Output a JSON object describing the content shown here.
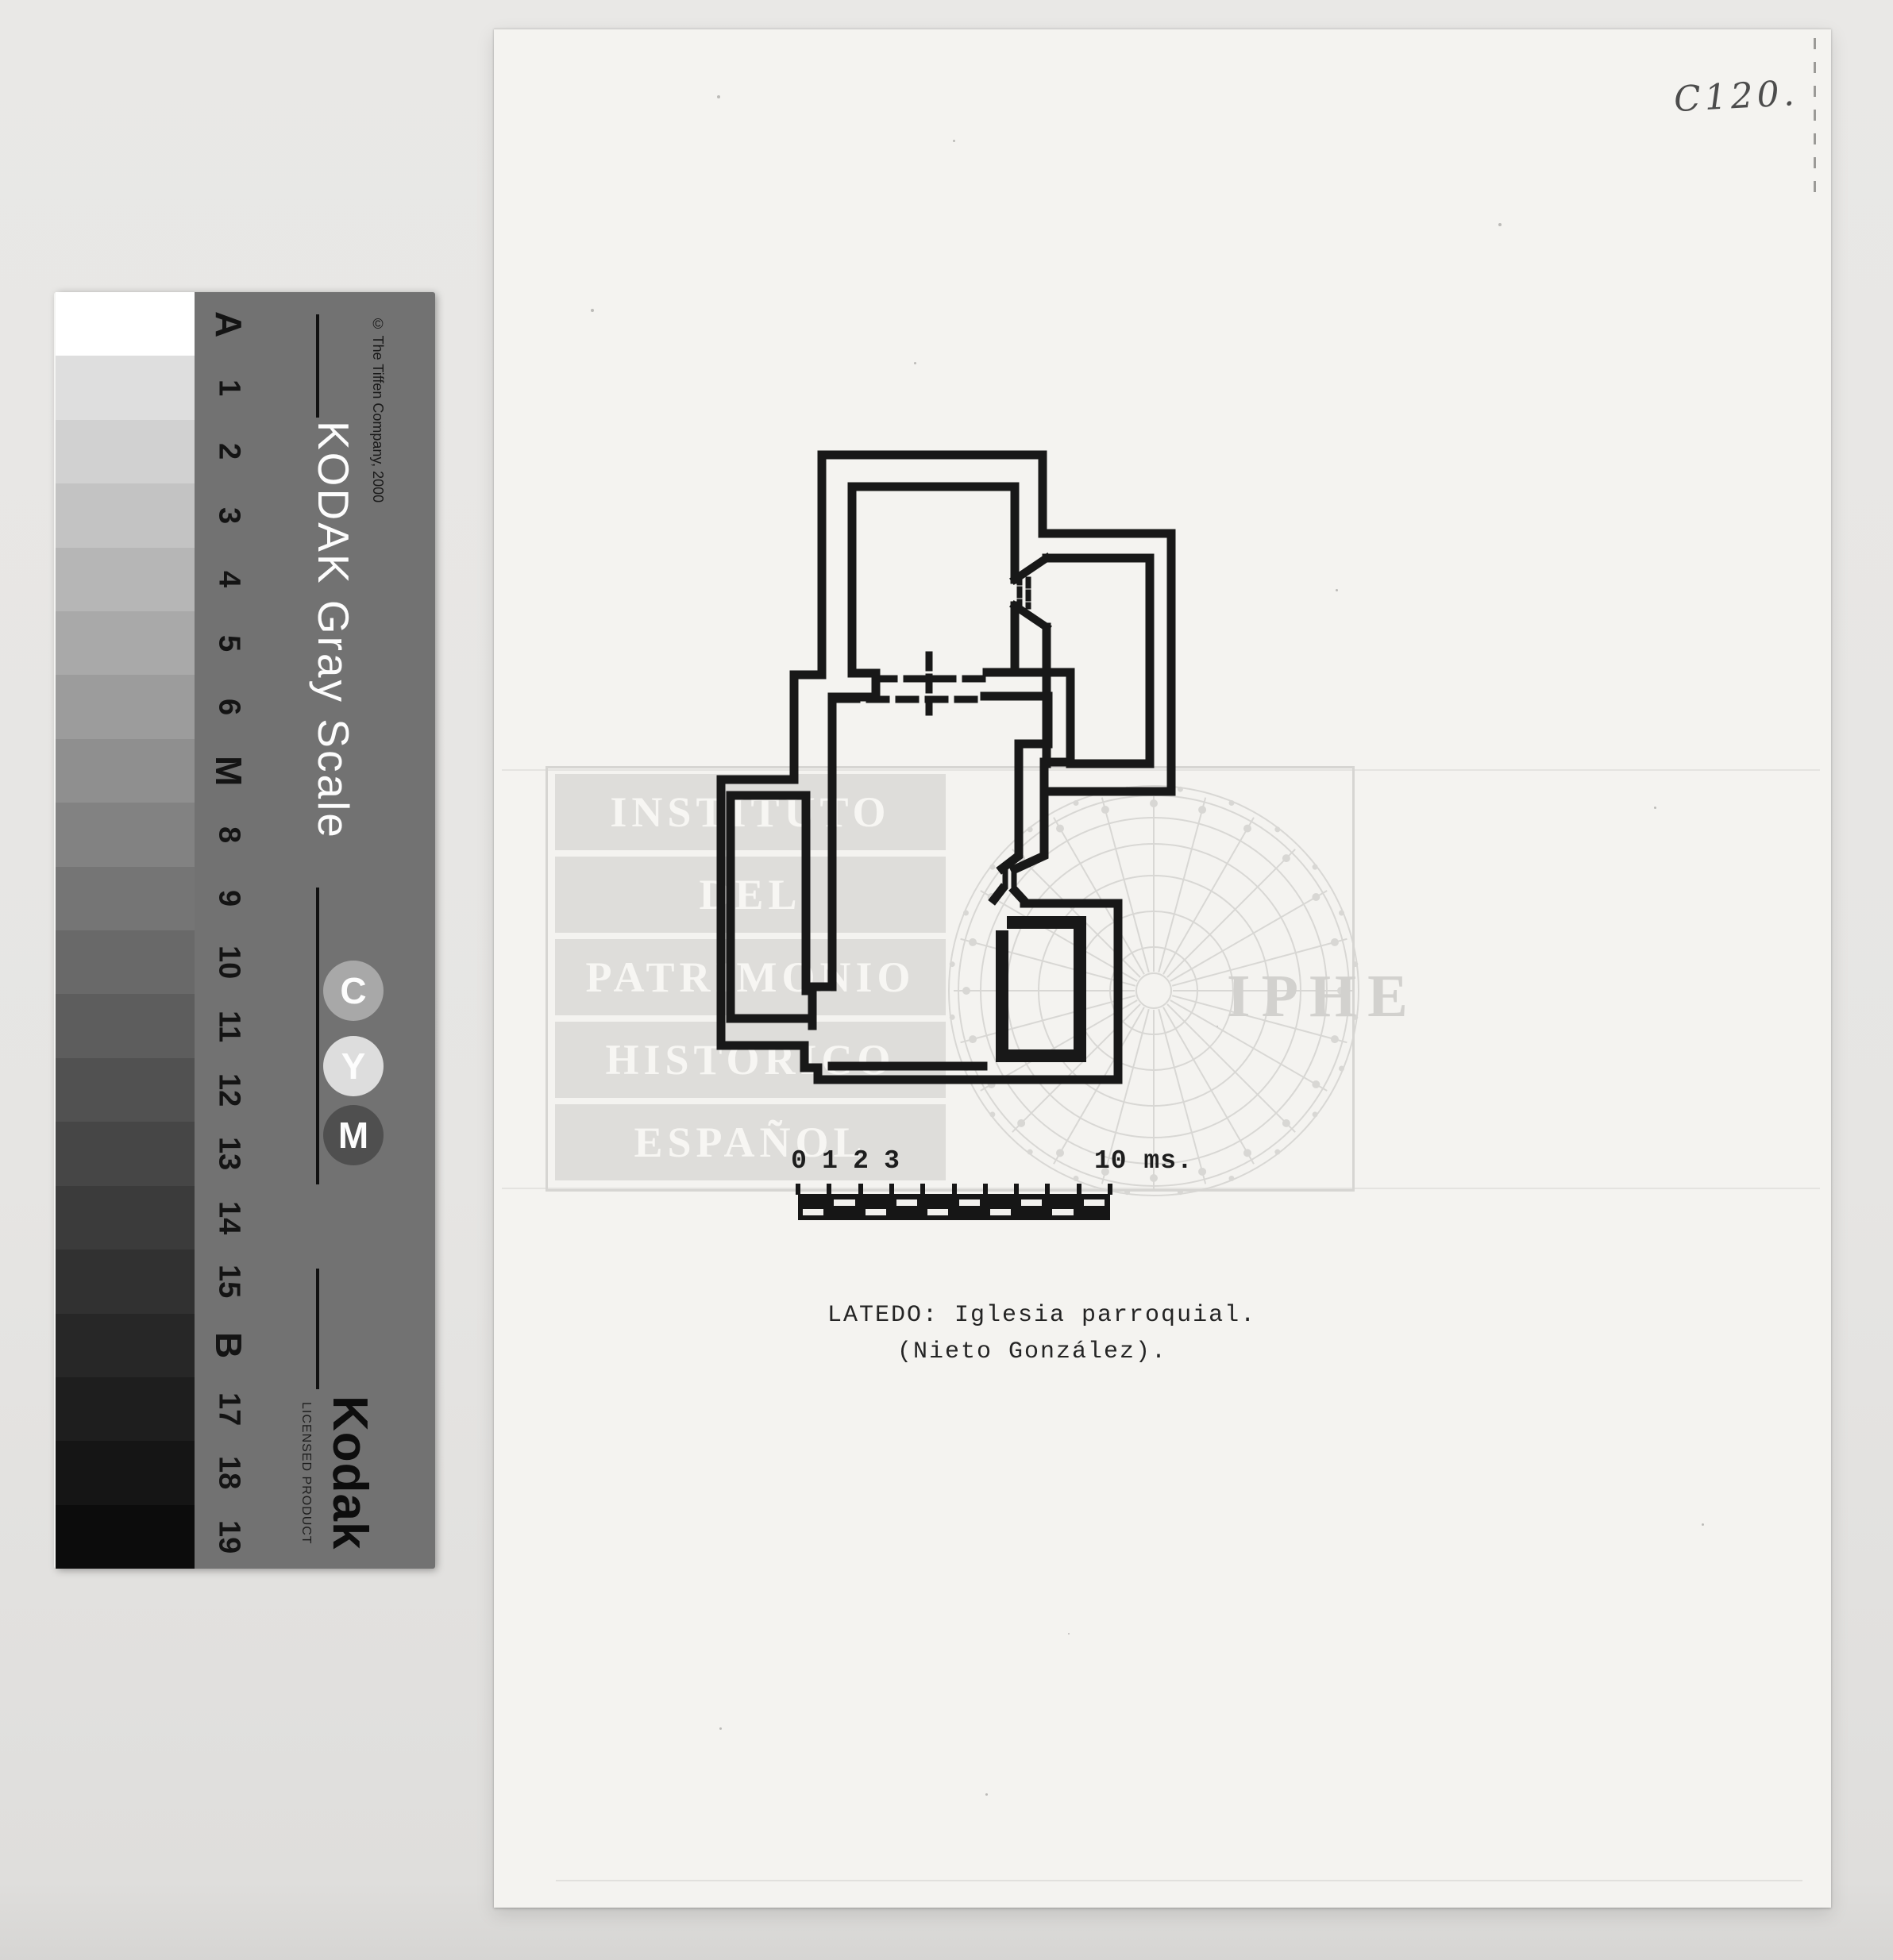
{
  "page": {
    "code": "C120."
  },
  "caption": {
    "line1": "LATEDO: Iglesia parroquial.",
    "line2": "(Nieto González)."
  },
  "scale_bar": {
    "tick_labels": [
      "0",
      "1",
      "2",
      "3"
    ],
    "end_label": "10 ms.",
    "divisions": 10
  },
  "watermark": {
    "lines": [
      "INSTITUTO",
      "DEL",
      "PATRIMONIO",
      "HISTORICO",
      "ESPAÑOL"
    ],
    "acronym": "IPHE"
  },
  "gray_scale": {
    "title": "KODAK Gray Scale",
    "copyright": "© The Tiffen Company, 2000",
    "brand": "Kodak",
    "brand_subtitle": "LICENSED PRODUCT",
    "step_labels": [
      "A",
      "1",
      "2",
      "3",
      "4",
      "5",
      "6",
      "M",
      "8",
      "9",
      "10",
      "11",
      "12",
      "13",
      "14",
      "15",
      "B",
      "17",
      "18",
      "19"
    ],
    "patch_shades": [
      "#ffffff",
      "#dedede",
      "#d1d1d1",
      "#c3c3c3",
      "#b6b6b6",
      "#a9a9a9",
      "#9c9c9c",
      "#8f8f8f",
      "#828282",
      "#757575",
      "#696969",
      "#5d5d5d",
      "#515151",
      "#464646",
      "#3b3b3b",
      "#313131",
      "#272727",
      "#1e1e1e",
      "#151515",
      "#0c0c0c"
    ],
    "cym_badges": [
      {
        "letter": "C",
        "color": "#a8a8a8"
      },
      {
        "letter": "Y",
        "color": "#dddddd"
      },
      {
        "letter": "M",
        "color": "#4f4f4f"
      }
    ],
    "panel_color": "#727272"
  },
  "colors": {
    "background": "#e8e7e5",
    "paper": "#f4f3f0",
    "ink": "#181818",
    "watermark": "#d6d5d2"
  }
}
